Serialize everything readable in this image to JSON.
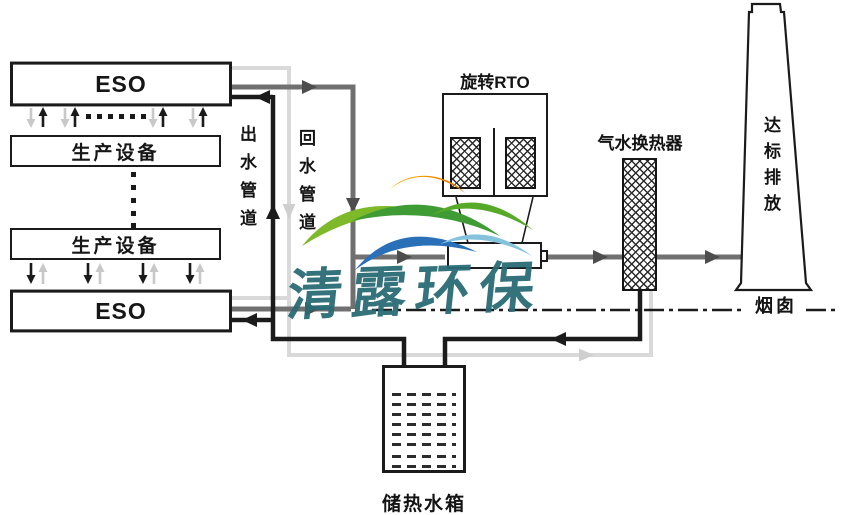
{
  "boxes": {
    "eso_top": {
      "label": "ESO"
    },
    "equipment_top": {
      "label": "生产设备"
    },
    "equipment_bottom": {
      "label": "生产设备"
    },
    "eso_bottom": {
      "label": "ESO"
    },
    "rto": {
      "label": "旋转RTO"
    },
    "heat_exchanger": {
      "label": "气水换热器"
    },
    "chimney": {
      "label": "达标排放",
      "caption": "烟囱"
    },
    "tank": {
      "label": "储热水箱"
    }
  },
  "pipe_labels": {
    "outlet": "出水管道",
    "return": "回水管道"
  },
  "watermark": {
    "text": "清露环保",
    "color": "#2a6b75"
  },
  "colors": {
    "gas_pipe": "#707070",
    "hot_water_pipe": "#1b1b1b",
    "return_water_pipe": "#d9d9d9",
    "outline": "#1b1b1b",
    "logo_orange": "#ee7000",
    "logo_yellow": "#f7b500",
    "logo_light_green": "#7db928",
    "logo_green": "#3f9c35",
    "logo_blue": "#2a70b8",
    "logo_light_blue": "#85c3dc"
  }
}
